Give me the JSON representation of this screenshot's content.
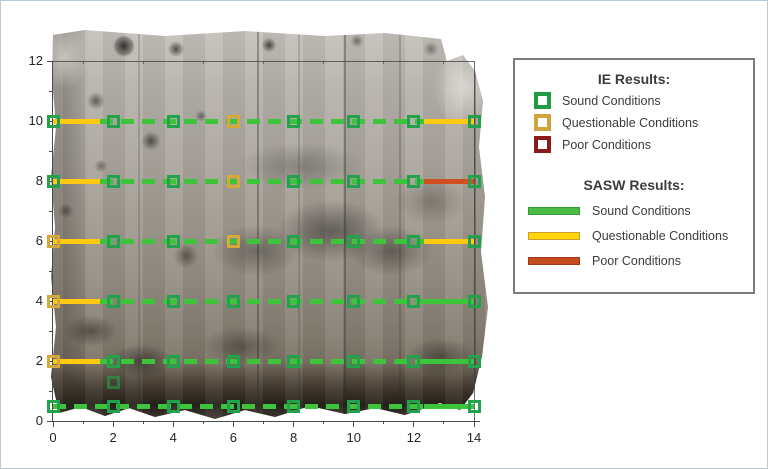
{
  "window": {
    "background": "#ffffff",
    "frame_color": "#b9c9d6"
  },
  "axes": {
    "x_ticks": [
      0,
      2,
      4,
      6,
      8,
      10,
      12,
      14
    ],
    "y_ticks": [
      0,
      2,
      4,
      6,
      8,
      10,
      12
    ],
    "x_minor": [
      1,
      3,
      5,
      7,
      9,
      11,
      13
    ],
    "y_minor": [
      1,
      3,
      5,
      7,
      9,
      11
    ]
  },
  "legend": {
    "ie_title": "IE Results:",
    "ie_items": [
      {
        "label": "Sound Conditions",
        "color": "#1f9b44"
      },
      {
        "label": "Questionable Conditions",
        "color": "#cfa43c"
      },
      {
        "label": "Poor Conditions",
        "color": "#8b1a18"
      }
    ],
    "sasw_title": "SASW Results:",
    "sasw_items": [
      {
        "label": "Sound Conditions",
        "fill": "#4cbb45",
        "border": "#2f9e3b"
      },
      {
        "label": "Questionable Conditions",
        "fill": "#ffd40a",
        "border": "#c8a12c"
      },
      {
        "label": "Poor Conditions",
        "fill": "#c64b1e",
        "border": "#9e3a14"
      }
    ]
  },
  "chart_data": {
    "type": "scatter",
    "title": "",
    "xlabel": "",
    "ylabel": "",
    "x_range": [
      0,
      14
    ],
    "y_range": [
      0,
      12
    ],
    "grid": false,
    "legend_position": "right-outside",
    "condition_colors": {
      "ie": {
        "sound": "#22a24a",
        "questionable": "#d5a83b",
        "poor": "#8b1a18"
      },
      "sasw": {
        "sound": "#3ec43b",
        "questionable": "#ffc813",
        "poor": "#d24e1e"
      }
    },
    "ie_points": [
      {
        "x": 0,
        "y": 10,
        "c": "sound"
      },
      {
        "x": 2,
        "y": 10,
        "c": "sound"
      },
      {
        "x": 4,
        "y": 10,
        "c": "sound"
      },
      {
        "x": 6,
        "y": 10,
        "c": "questionable"
      },
      {
        "x": 8,
        "y": 10,
        "c": "sound"
      },
      {
        "x": 10,
        "y": 10,
        "c": "sound"
      },
      {
        "x": 12,
        "y": 10,
        "c": "sound"
      },
      {
        "x": 14,
        "y": 10,
        "c": "sound"
      },
      {
        "x": 0,
        "y": 8,
        "c": "sound"
      },
      {
        "x": 2,
        "y": 8,
        "c": "sound"
      },
      {
        "x": 4,
        "y": 8,
        "c": "sound"
      },
      {
        "x": 6,
        "y": 8,
        "c": "questionable"
      },
      {
        "x": 8,
        "y": 8,
        "c": "sound"
      },
      {
        "x": 10,
        "y": 8,
        "c": "sound"
      },
      {
        "x": 12,
        "y": 8,
        "c": "sound"
      },
      {
        "x": 14,
        "y": 8,
        "c": "sound"
      },
      {
        "x": 0,
        "y": 6,
        "c": "questionable"
      },
      {
        "x": 2,
        "y": 6,
        "c": "sound"
      },
      {
        "x": 4,
        "y": 6,
        "c": "sound"
      },
      {
        "x": 6,
        "y": 6,
        "c": "questionable"
      },
      {
        "x": 8,
        "y": 6,
        "c": "sound"
      },
      {
        "x": 10,
        "y": 6,
        "c": "sound"
      },
      {
        "x": 12,
        "y": 6,
        "c": "sound"
      },
      {
        "x": 14,
        "y": 6,
        "c": "sound"
      },
      {
        "x": 0,
        "y": 4,
        "c": "questionable"
      },
      {
        "x": 2,
        "y": 4,
        "c": "sound"
      },
      {
        "x": 4,
        "y": 4,
        "c": "sound"
      },
      {
        "x": 6,
        "y": 4,
        "c": "sound"
      },
      {
        "x": 8,
        "y": 4,
        "c": "sound"
      },
      {
        "x": 10,
        "y": 4,
        "c": "sound"
      },
      {
        "x": 12,
        "y": 4,
        "c": "sound"
      },
      {
        "x": 14,
        "y": 4,
        "c": "sound"
      },
      {
        "x": 0,
        "y": 2,
        "c": "questionable"
      },
      {
        "x": 2,
        "y": 2,
        "c": "sound"
      },
      {
        "x": 4,
        "y": 2,
        "c": "sound"
      },
      {
        "x": 6,
        "y": 2,
        "c": "sound"
      },
      {
        "x": 8,
        "y": 2,
        "c": "sound"
      },
      {
        "x": 10,
        "y": 2,
        "c": "sound"
      },
      {
        "x": 12,
        "y": 2,
        "c": "sound"
      },
      {
        "x": 14,
        "y": 2,
        "c": "sound"
      },
      {
        "x": 0,
        "y": 0.5,
        "c": "sound"
      },
      {
        "x": 2,
        "y": 0.5,
        "c": "sound"
      },
      {
        "x": 4,
        "y": 0.5,
        "c": "sound"
      },
      {
        "x": 6,
        "y": 0.5,
        "c": "sound"
      },
      {
        "x": 8,
        "y": 0.5,
        "c": "sound"
      },
      {
        "x": 10,
        "y": 0.5,
        "c": "sound"
      },
      {
        "x": 12,
        "y": 0.5,
        "c": "sound"
      },
      {
        "x": 14,
        "y": 0.5,
        "c": "sound"
      },
      {
        "x": 2,
        "y": 1.3,
        "c": "sound",
        "faint": true
      }
    ],
    "sasw_segments": [
      {
        "y": 10,
        "x1": 0,
        "x2": 1.55,
        "c": "questionable",
        "style": "solid"
      },
      {
        "y": 10,
        "x1": 1.55,
        "x2": 12.35,
        "c": "sound",
        "style": "dashed"
      },
      {
        "y": 10,
        "x1": 12.35,
        "x2": 14,
        "c": "questionable",
        "style": "solid"
      },
      {
        "y": 8,
        "x1": 0,
        "x2": 1.55,
        "c": "questionable",
        "style": "solid"
      },
      {
        "y": 8,
        "x1": 1.55,
        "x2": 12.35,
        "c": "sound",
        "style": "dashed"
      },
      {
        "y": 8,
        "x1": 12.35,
        "x2": 14,
        "c": "poor",
        "style": "solid"
      },
      {
        "y": 6,
        "x1": 0,
        "x2": 1.55,
        "c": "questionable",
        "style": "solid"
      },
      {
        "y": 6,
        "x1": 1.55,
        "x2": 12.35,
        "c": "sound",
        "style": "dashed"
      },
      {
        "y": 6,
        "x1": 12.35,
        "x2": 14,
        "c": "questionable",
        "style": "solid"
      },
      {
        "y": 4,
        "x1": 0,
        "x2": 1.55,
        "c": "questionable",
        "style": "solid"
      },
      {
        "y": 4,
        "x1": 1.55,
        "x2": 12.35,
        "c": "sound",
        "style": "dashed"
      },
      {
        "y": 4,
        "x1": 12.35,
        "x2": 14,
        "c": "sound",
        "style": "solid"
      },
      {
        "y": 2,
        "x1": 0,
        "x2": 1.55,
        "c": "questionable",
        "style": "solid"
      },
      {
        "y": 2,
        "x1": 1.55,
        "x2": 12.35,
        "c": "sound",
        "style": "dashed"
      },
      {
        "y": 2,
        "x1": 12.35,
        "x2": 14,
        "c": "sound",
        "style": "solid"
      },
      {
        "y": 0.5,
        "x1": 0,
        "x2": 12.35,
        "c": "sound",
        "style": "dashed"
      },
      {
        "y": 0.5,
        "x1": 12.35,
        "x2": 14,
        "c": "sound",
        "style": "solid"
      }
    ]
  }
}
